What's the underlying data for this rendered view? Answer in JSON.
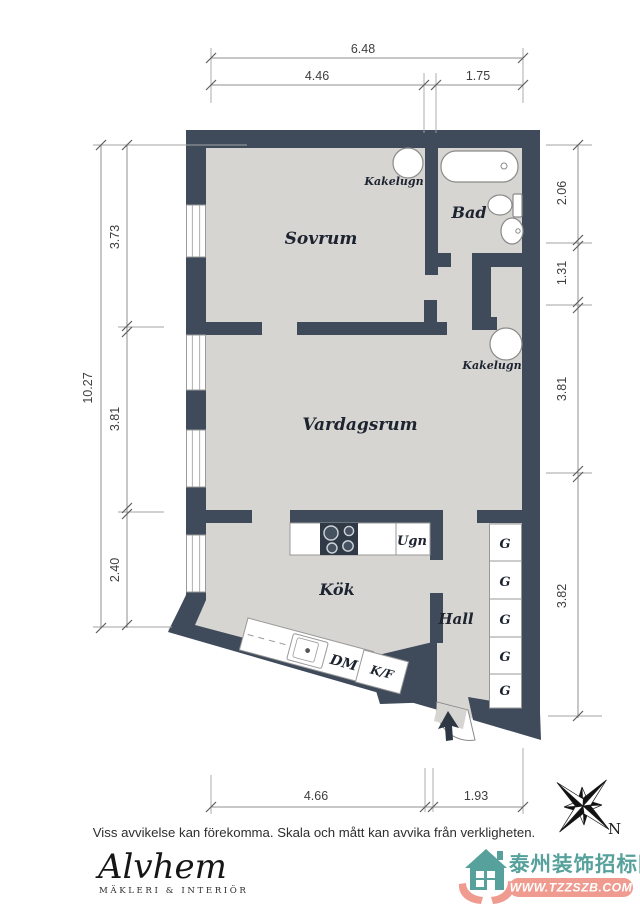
{
  "plan": {
    "room_labels": {
      "sovrum": "Sovrum",
      "bad": "Bad",
      "vardagsrum": "Vardagsrum",
      "kok": "Kök",
      "hall": "Hall"
    },
    "feature_labels": {
      "kakelugn_sovrum": "Kakelugn",
      "kakelugn_vardagsrum": "Kakelugn",
      "oven": "Ugn",
      "dishwasher": "DM",
      "fridge_freezer": "K/F",
      "wardrobes": [
        "G",
        "G",
        "G",
        "G",
        "G"
      ]
    },
    "compass": {
      "north": "N"
    }
  },
  "dimensions": {
    "top": {
      "total": "6.48",
      "left": "4.46",
      "right": "1.75"
    },
    "left": {
      "total": "10.27",
      "top": "3.73",
      "middle": "3.81",
      "bottom": "2.40"
    },
    "right": {
      "d1": "2.06",
      "d2": "1.31",
      "d3": "3.81",
      "d4": "3.82"
    },
    "bottom": {
      "left": "4.66",
      "right": "1.93"
    }
  },
  "footer": {
    "disclaimer": "Viss avvikelse kan förekomma. Skala och mått kan avvika från verkligheten.",
    "brand": {
      "name": "Alvhem",
      "tagline": "MÄKLERI & INTERIÖR"
    }
  },
  "watermark": {
    "site_name": "泰州装饰招标网",
    "site_url": "WWW.TZZSZB.COM"
  },
  "colors": {
    "wall": "#3f4b5b",
    "floor": "#d6d5d2",
    "label": "#1d2430",
    "watermark_teal": "#56a19b",
    "watermark_salmon": "#f09b90"
  }
}
